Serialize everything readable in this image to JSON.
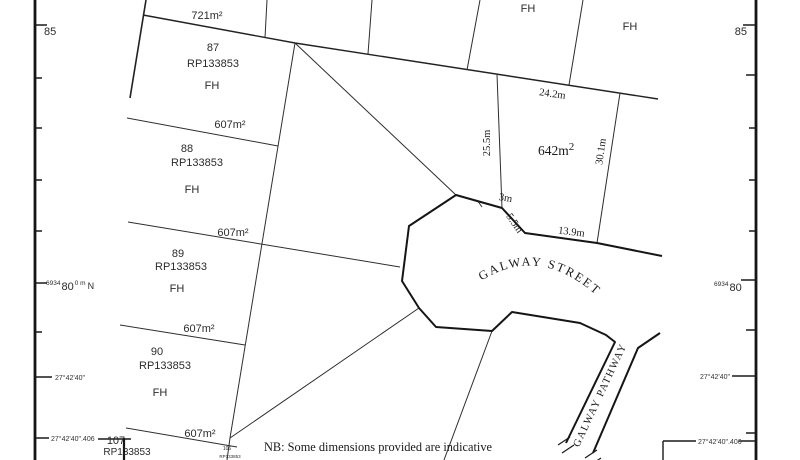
{
  "note": "NB: Some dimensions provided are indicative",
  "streets": {
    "street": "GALWAY STREET",
    "pathway": "GALWAY PATHWAY"
  },
  "lots": {
    "lot721": {
      "area": "721m²"
    },
    "lot87": {
      "number": "87",
      "plan": "RP133853",
      "tenure": "FH"
    },
    "fh_top_a": "FH",
    "fh_top_b": "FH",
    "lot88": {
      "area": "607m²",
      "number": "88",
      "plan": "RP133853",
      "tenure": "FH"
    },
    "lot89": {
      "area": "607m²",
      "number": "89",
      "plan": "RP133853",
      "tenure": "FH"
    },
    "lot90": {
      "area": "607m²",
      "number": "90",
      "plan": "RP133853",
      "tenure": "FH"
    },
    "lot107": {
      "area": "607m²",
      "number": "107",
      "plan": "RP133853"
    },
    "lot106": {
      "number": "106",
      "plan": "RP133853"
    },
    "lot642": {
      "area_base": "642m",
      "area_exponent": "2"
    }
  },
  "dimensions": {
    "top": "24.2m",
    "west": "25.5m",
    "east": "30.1m",
    "short": "3m",
    "splay": "5.5m",
    "frontage": "13.9m"
  },
  "grid": {
    "northing_85_left": "85",
    "northing_85_right": "85",
    "northing_prefix": "6934",
    "northing_80": "80",
    "northing_sup": "0 m",
    "north_axis": "N",
    "latitude": "27°42'40\"",
    "latitude_406": "27°42'40\".406"
  },
  "colors": {
    "highlight_area": "#cc1111",
    "ink": "#1a1a1a"
  }
}
